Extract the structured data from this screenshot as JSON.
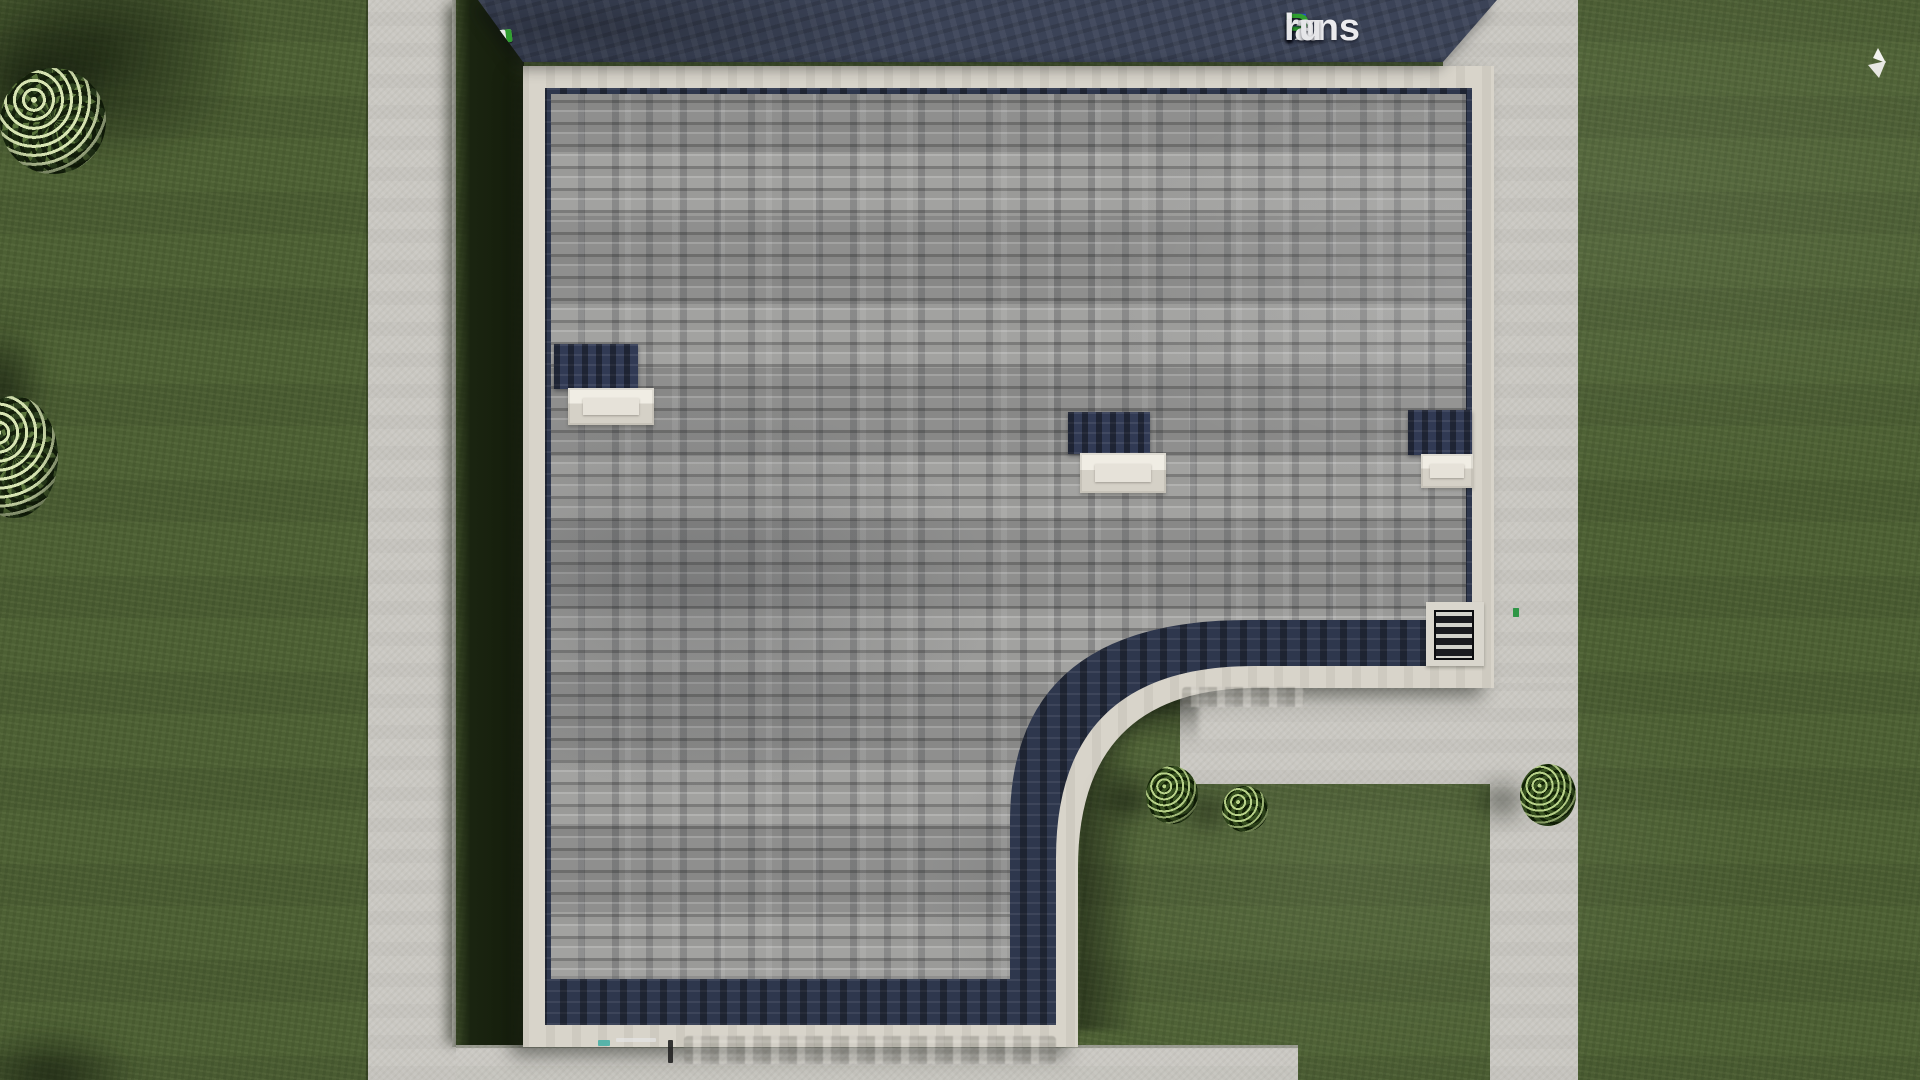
{
  "brand": {
    "name": "FixPlans.ru",
    "logo_parts": [
      {
        "t": "F",
        "c": "#2a52d8"
      },
      {
        "t": "ix",
        "c": "#ebebee"
      },
      {
        "t": "P",
        "c": "#2fa02f"
      },
      {
        "t": "lans",
        "c": "#ebebee"
      },
      {
        "t": ".",
        "c": "#2a52d8"
      },
      {
        "t": "ru",
        "c": "#e6e6e9"
      }
    ]
  },
  "top_band_strip": {
    "segments": [
      {
        "c": "#e8e8e8",
        "w": 34
      },
      {
        "c": "#e8e8e8",
        "w": 26
      },
      {
        "c": "#2a52d8",
        "w": 14
      },
      {
        "c": "#e8e8e8",
        "w": 28
      },
      {
        "c": "#e8e8e8",
        "w": 28
      },
      {
        "c": "#e8e8e8",
        "w": 26
      },
      {
        "c": "#e8e8e8",
        "w": 10
      },
      {
        "c": "#2fa02f",
        "w": 34
      },
      {
        "c": "#e8e8e8",
        "w": 28
      },
      {
        "c": "#2fa02f",
        "w": 11
      },
      {
        "c": "#2a52d8",
        "w": 21
      }
    ]
  },
  "walkway_marks": {
    "segments": [
      {
        "c": "#4ab0a6",
        "w": 12
      },
      {
        "c": "#e8e8e8",
        "w": 38
      },
      {
        "c": "#2a52d8",
        "w": 9
      }
    ]
  },
  "edge_specks": {
    "segments": [
      {
        "c": "#2fa02f"
      },
      {
        "c": "#2a52d8"
      },
      {
        "c": "#2fa02f"
      }
    ]
  },
  "colors": {
    "grass": "#4d6034",
    "grass_shadow": "#1a2410",
    "concrete": "#cac8c2",
    "roof_trim": "#d8d4ca",
    "roof_shingle": "#9c9c9a",
    "eave_navy": "#2e374d",
    "neighbor_roof_band": "#3b4357",
    "skylight_glass": "#313a54",
    "logo_blue": "#2a52d8",
    "logo_green": "#2fa02f",
    "bird_white": "#f2f2ef"
  }
}
